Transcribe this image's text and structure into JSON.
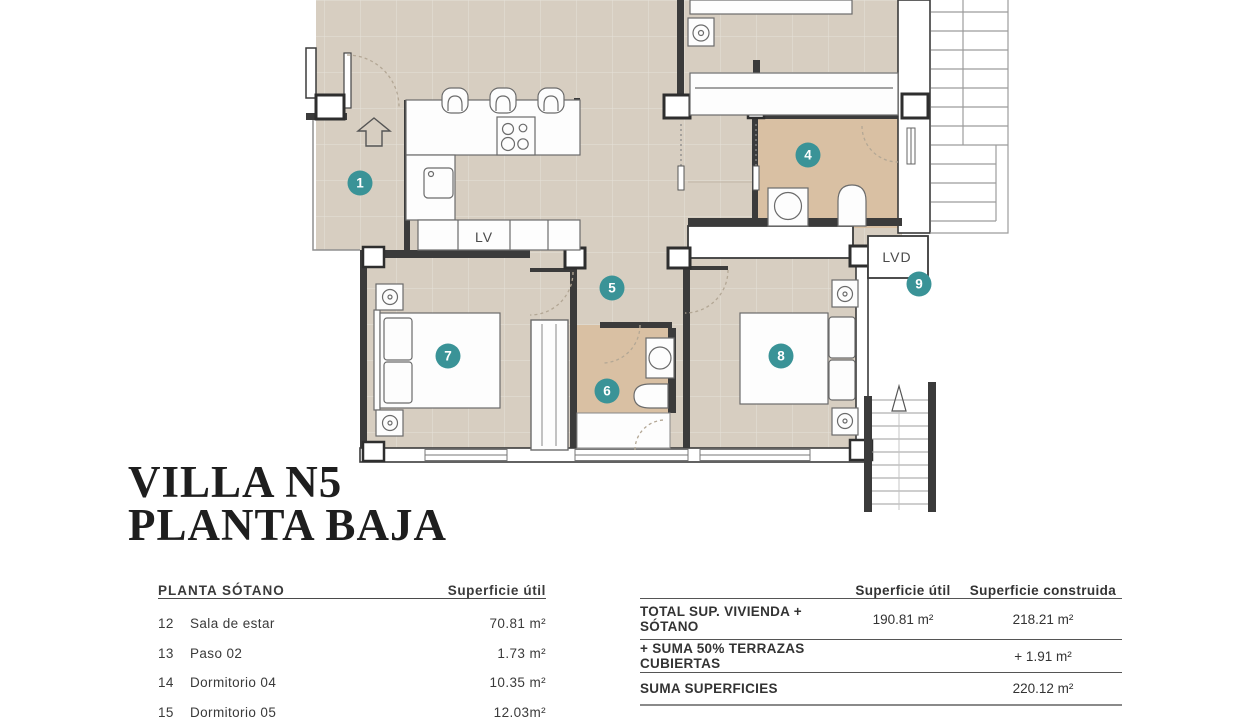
{
  "title": {
    "line1": "VILLA N5",
    "line2": "PLANTA BAJA"
  },
  "plan": {
    "badges": [
      {
        "label": "1"
      },
      {
        "label": "4"
      },
      {
        "label": "5"
      },
      {
        "label": "6"
      },
      {
        "label": "7"
      },
      {
        "label": "8"
      },
      {
        "label": "9"
      }
    ],
    "labels": {
      "dishwasher": "LV",
      "washer_dryer": "LVD"
    }
  },
  "left_table": {
    "header": {
      "title": "PLANTA SÓTANO",
      "col": "Superficie útil"
    },
    "rows": [
      {
        "num": "12",
        "name": "Sala de estar",
        "value": "70.81 m²"
      },
      {
        "num": "13",
        "name": "Paso 02",
        "value": "1.73 m²"
      },
      {
        "num": "14",
        "name": "Dormitorio 04",
        "value": "10.35 m²"
      },
      {
        "num": "15",
        "name": "Dormitorio 05",
        "value": "12.03m²"
      }
    ]
  },
  "right_table": {
    "headers": {
      "col1": "Superficie útil",
      "col2": "Superficie construida"
    },
    "rows": [
      {
        "label": "TOTAL SUP. VIVIENDA + SÓTANO",
        "util": "190.81  m²",
        "construida": "218.21 m²"
      },
      {
        "label": "+ SUMA 50% TERRAZAS CUBIERTAS",
        "util": "",
        "construida": "+ 1.91 m²"
      },
      {
        "label": "SUMA SUPERFICIES",
        "util": "",
        "construida": "220.12 m²"
      }
    ]
  },
  "colors": {
    "accent_badge": "#3A9397",
    "floor": "#D7CEC1",
    "bathroom_floor": "#D9C0A3",
    "wall": "#3B3B3B"
  }
}
